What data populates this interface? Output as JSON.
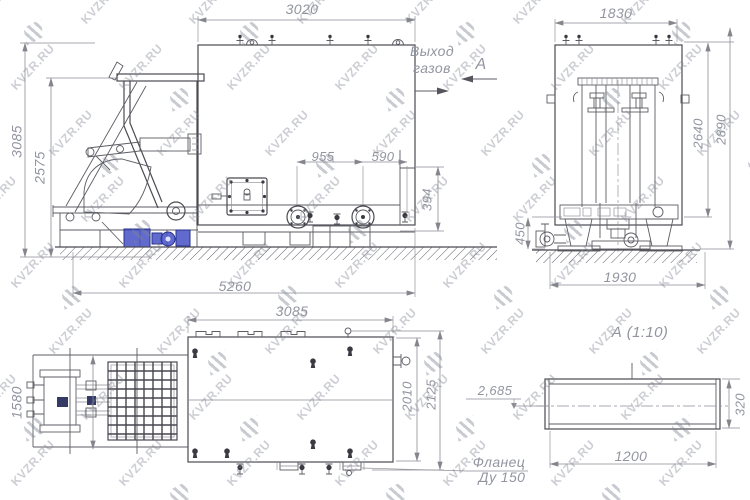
{
  "watermark": {
    "text": "KVZR.RU"
  },
  "side_view": {
    "dim_top_width": "3020",
    "dim_height_overall": "3085",
    "dim_height_hopper": "2575",
    "dim_length_overall": "5260",
    "dim_flange_spacing": "955",
    "dim_flange_to_outlet": "590",
    "dim_outlet_height": "394",
    "label_gas_outlet_line1": "Выход",
    "label_gas_outlet_line2": "газов",
    "label_view_letter": "А"
  },
  "end_view": {
    "dim_top_width": "1830",
    "dim_height_inner": "2640",
    "dim_height_overall": "2890",
    "dim_foundation_height": "450",
    "dim_base_width": "1930"
  },
  "plan_view": {
    "dim_length": "3085",
    "dim_cart_width": "1580",
    "dim_width_inner": "2010",
    "dim_width_overall": "2125",
    "label_flange_line1": "Фланец",
    "label_flange_line2": "Ду 150"
  },
  "detail_view": {
    "title": "А (1:10)",
    "dim_length": "1200",
    "dim_height": "320",
    "label_elevation": "2,685"
  }
}
